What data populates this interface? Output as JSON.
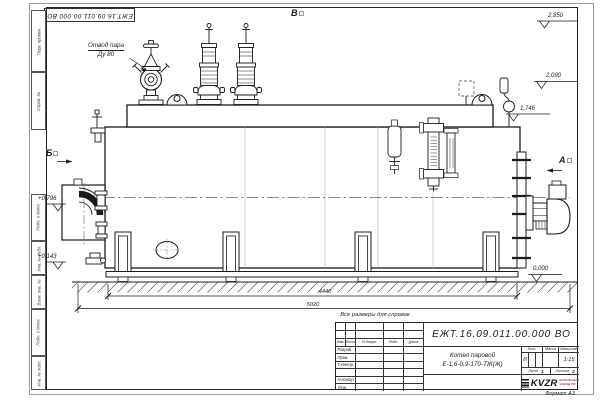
{
  "doc": {
    "number": "ЕЖТ.16.09.011.00.000 ВО",
    "format_note": "Формат А3"
  },
  "labels": {
    "steam_outlet1": "Отвод пара",
    "steam_outlet2": "Ду 80",
    "view_a": "А",
    "view_b": "Б",
    "view_v": "В",
    "ref_note": "Все размеры для справок"
  },
  "elevations": {
    "e2850": "2,850",
    "e2090": "2,090",
    "e1746": "1,746",
    "e0796": "+0,796",
    "e0143": "+0,143",
    "e0000": "0,000"
  },
  "dims": {
    "d1": "4440",
    "d2": "5020"
  },
  "margin_cells": [
    "Перв. примен.",
    "Справ. №",
    "Подп. и дата",
    "Инв. № дубл.",
    "Взам. инв. №",
    "Подп. и дата",
    "Инв. № подл."
  ],
  "title_block": {
    "cols": [
      "Изм.",
      "Лист",
      "N докум.",
      "Подп.",
      "Дата"
    ],
    "rows": [
      "Разраб.",
      "Пров.",
      "Т.контр.",
      "",
      "Н.контр.",
      "Утв."
    ],
    "product_name1": "Котел паровой",
    "product_name2": "Е-1,6-0,9-170-ТЖ(Ж)",
    "lit_label": "Лит.",
    "mass_label": "Масса",
    "scale_label": "Масштаб",
    "lit_value": "И",
    "scale_value": "1:15",
    "sheet_label": "Лист",
    "sheet_num": "1",
    "sheets_label": "Листов",
    "sheets_num": "2",
    "brand": "KVZR",
    "brand_sub1": "КОТЕЛЬНЫЙ",
    "brand_sub2": "ЗАВОД РФ"
  }
}
